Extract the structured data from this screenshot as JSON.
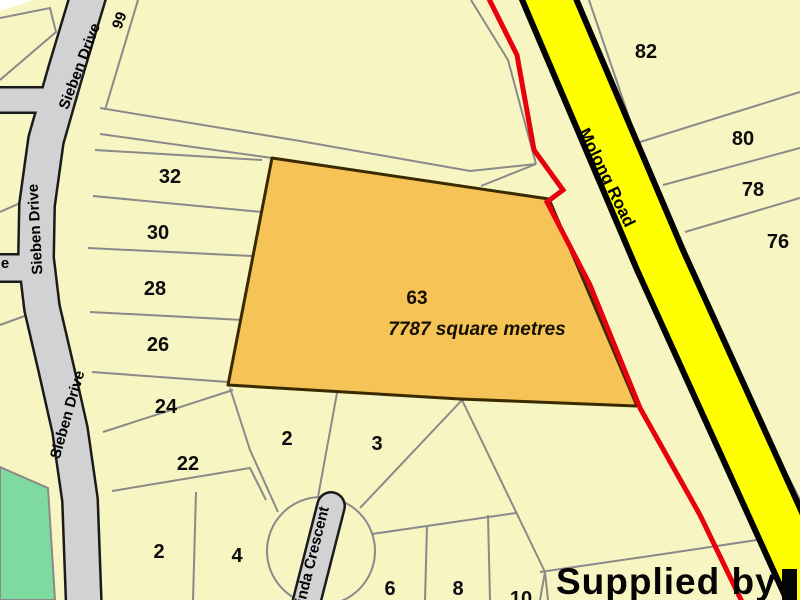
{
  "streets": {
    "sieben_drive": "Sieben Drive",
    "molong_road": "Molong Road",
    "crescent_partial": "inda Crescent",
    "left_street_partial": "e"
  },
  "highlight_lot": {
    "number": "63",
    "area": "7787 square metres"
  },
  "lots": {
    "l99": "99",
    "l32": "32",
    "l30": "30",
    "l28": "28",
    "l26": "26",
    "l24": "24",
    "l22": "22",
    "l2_left": "2",
    "l4": "4",
    "l2_mid": "2",
    "l3": "3",
    "l6": "6",
    "l8": "8",
    "l10": "10",
    "l82": "82",
    "l80": "80",
    "l78": "78",
    "l76": "76"
  },
  "watermark": {
    "text": "Supplied by"
  },
  "colors": {
    "lot_fill": "#F7F5C2",
    "highlight_fill": "#F5C356",
    "highway_yellow": "#FFFF00",
    "road_gray": "#D2D2D4",
    "boundary_red": "#E8000D",
    "park_green": "#7EDA9E",
    "parcel_line": "#8A8A8A"
  }
}
